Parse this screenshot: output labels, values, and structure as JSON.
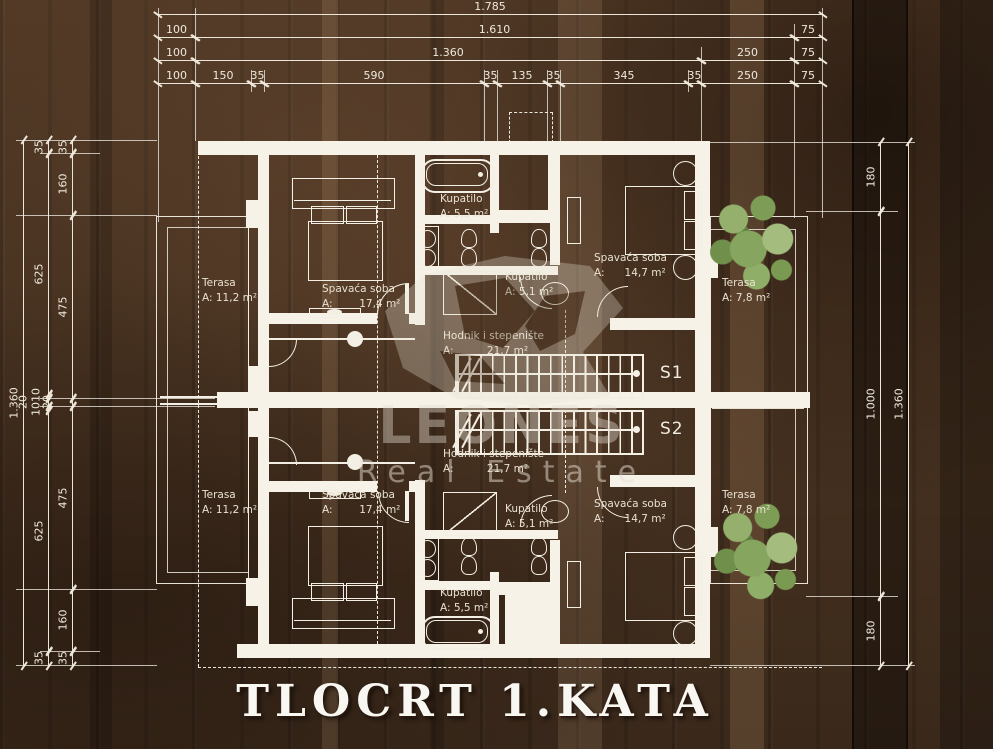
{
  "title": "TLOCRT 1.KATA",
  "watermark": {
    "brand": "LEONES",
    "tagline": "Real Estate"
  },
  "stairs": {
    "s1": "S1",
    "s2": "S2"
  },
  "rooms": [
    {
      "name": "Terasa",
      "area": "A: 11,2 m²"
    },
    {
      "name": "Spavaća soba",
      "area": "A:        17,4 m²"
    },
    {
      "name": "Kupatilo",
      "area": "A: 5,5 m²"
    },
    {
      "name": "Kupatilo",
      "area": "A: 5,1 m²"
    },
    {
      "name": "Spavaća soba",
      "area": "A:      14,7 m²"
    },
    {
      "name": "Terasa",
      "area": "A: 7,8 m²"
    },
    {
      "name": "Hodnik i stepenište",
      "area": "A:          21,7 m²"
    },
    {
      "name": "Hodnik i stepenište",
      "area": "A:          21,7 m²"
    },
    {
      "name": "Terasa",
      "area": "A: 11,2 m²"
    },
    {
      "name": "Spavaća soba",
      "area": "A:        17,4 m²"
    },
    {
      "name": "Kupatilo",
      "area": "A: 5,1 m²"
    },
    {
      "name": "Spavaća soba",
      "area": "A:      14,7 m²"
    },
    {
      "name": "Terasa",
      "area": "A: 7,8 m²"
    },
    {
      "name": "Kupatilo",
      "area": "A: 5,5 m²"
    }
  ],
  "dims": {
    "top_row1": [
      "1.785"
    ],
    "top_row2": [
      "100",
      "1.610",
      "75"
    ],
    "top_row3": [
      "100",
      "1.360",
      "250",
      "75"
    ],
    "top_row4": [
      "100",
      "150",
      "35",
      "590",
      "35",
      "135",
      "35",
      "345",
      "35",
      "250",
      "75"
    ],
    "left_col_outer": [
      "1.360"
    ],
    "left_col_mid": [
      "35",
      "625",
      "10",
      "20",
      "10",
      "625",
      "35"
    ],
    "left_col_inner": [
      "35",
      "160",
      "475",
      "20",
      "475",
      "160",
      "35"
    ],
    "right_col_inner": [
      "180",
      "1.000",
      "180"
    ],
    "right_col_outer": [
      "1.360"
    ]
  },
  "colors": {
    "background": "#4a3422",
    "line": "#f4efe4",
    "tree_green": "#8aa864",
    "band_olive": "#cdc180"
  }
}
